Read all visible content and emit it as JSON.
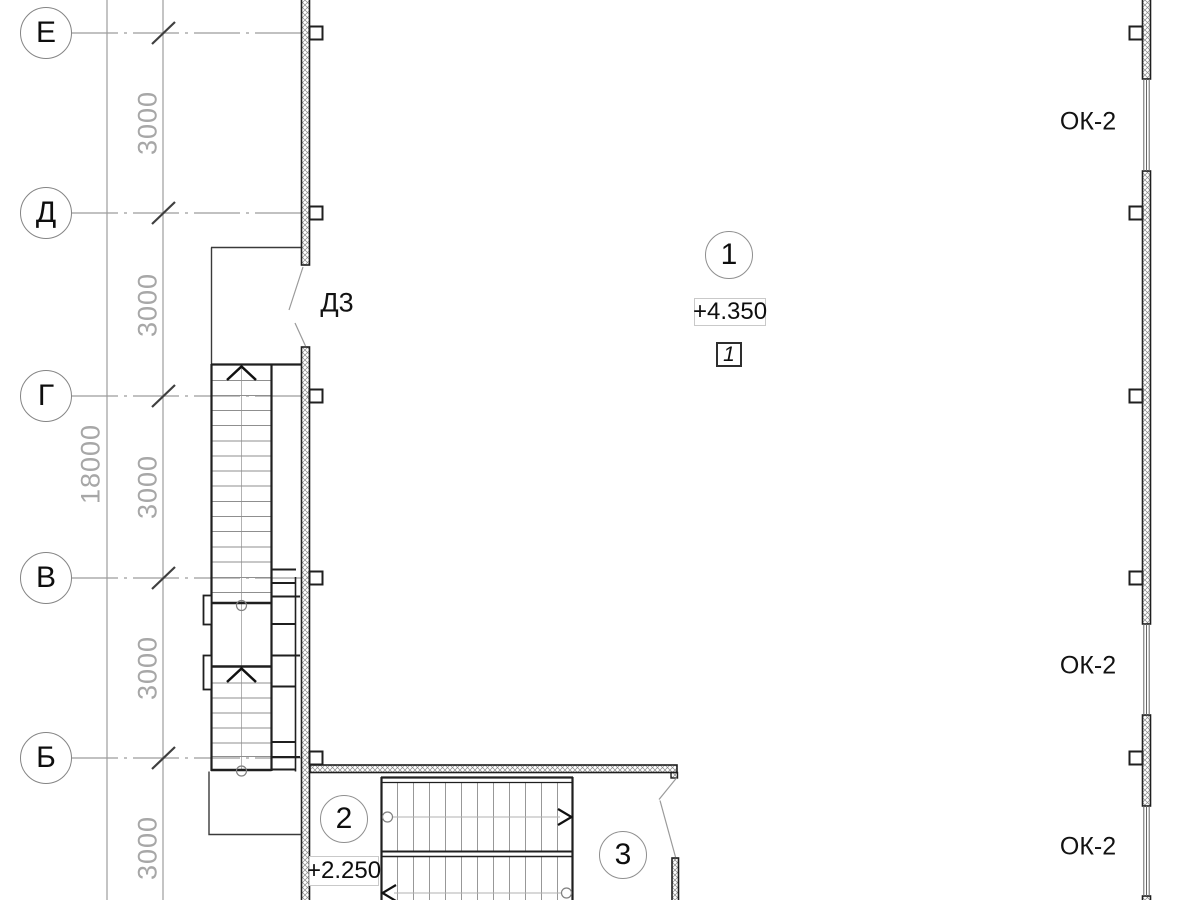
{
  "plan": {
    "axes": [
      {
        "label": "Е"
      },
      {
        "label": "Д"
      },
      {
        "label": "Г"
      },
      {
        "label": "В"
      },
      {
        "label": "Б"
      }
    ],
    "bay_dims": [
      "3000",
      "3000",
      "3000",
      "3000",
      "3000"
    ],
    "overall_dim": "18000",
    "door": {
      "label": "Д3"
    },
    "windows": [
      {
        "label": "ОК-2"
      },
      {
        "label": "ОК-2"
      },
      {
        "label": "ОК-2"
      }
    ],
    "rooms": [
      {
        "number": "1"
      },
      {
        "number": "2"
      },
      {
        "number": "3"
      }
    ],
    "elevations": [
      {
        "value": "+4.350"
      },
      {
        "value": "+2.250"
      }
    ],
    "section_mark": {
      "value": "1"
    },
    "colors": {
      "line_dark": "#1f1f1f",
      "line_gray": "#9c9c9c",
      "hatch_gray": "#8a8a8a"
    }
  }
}
